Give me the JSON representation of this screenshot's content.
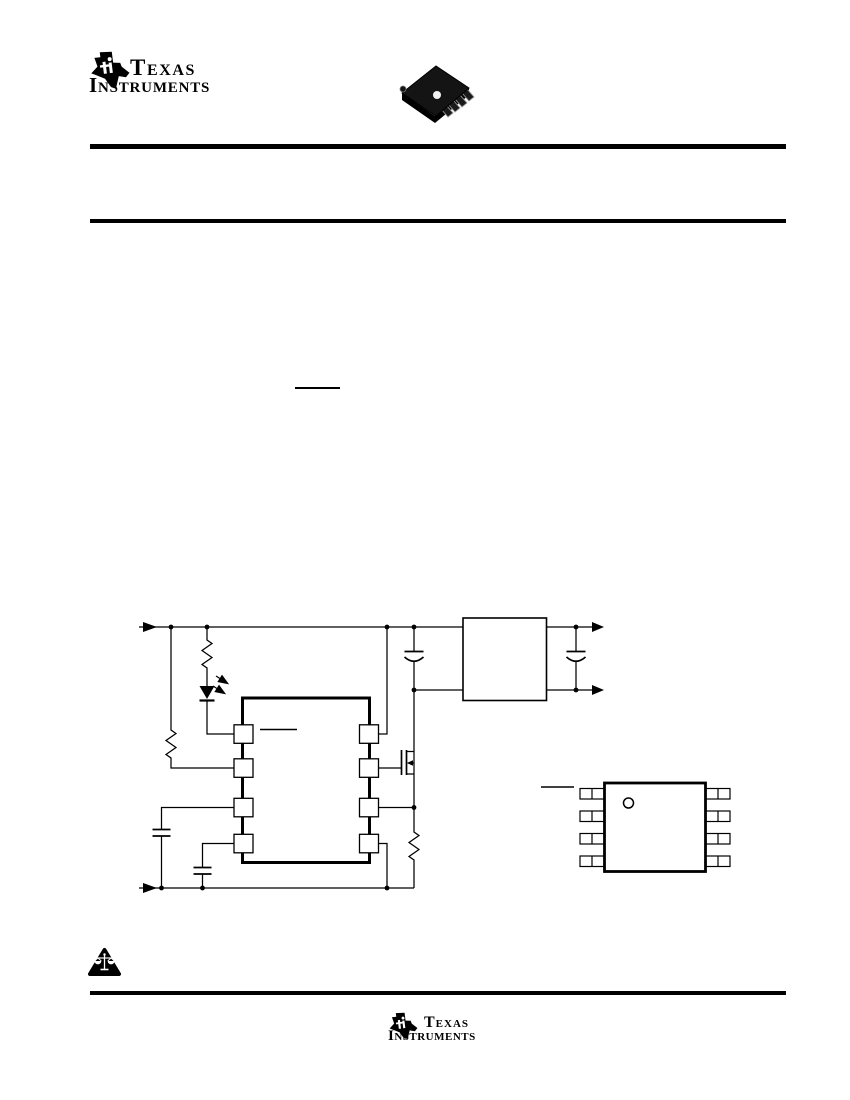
{
  "page": {
    "width": 850,
    "height": 1100,
    "background": "#ffffff",
    "ink_color": "#000000"
  },
  "brand": {
    "name_line1": "Texas",
    "name_line2": "Instruments"
  },
  "header": {
    "package_photo": "msop-8-surface-mount-package-photo",
    "rules": [
      "header-top-rule",
      "header-bottom-rule"
    ]
  },
  "artifacts": {
    "body_overline": "overbar-of-redacted-text",
    "schematic_pin_overline": "overbar-of-redacted-pin-label",
    "pinout_overline": "overbar-of-redacted-pin-label"
  },
  "schematic": {
    "title": "typical-application-circuit",
    "ic": {
      "type": "8-pin-controller",
      "left_pins": 4,
      "right_pins": 4
    },
    "components": [
      {
        "name": "input-terminal-arrow",
        "type": "terminal"
      },
      {
        "name": "r1",
        "type": "resistor"
      },
      {
        "name": "r2",
        "type": "resistor"
      },
      {
        "name": "d1",
        "type": "led-with-emission-arrows"
      },
      {
        "name": "q1",
        "type": "n-channel-mosfet"
      },
      {
        "name": "c1",
        "type": "capacitor"
      },
      {
        "name": "c2",
        "type": "capacitor"
      },
      {
        "name": "c3",
        "type": "polarized-capacitor"
      },
      {
        "name": "c4",
        "type": "polarized-capacitor"
      },
      {
        "name": "r3",
        "type": "resistor"
      },
      {
        "name": "t1",
        "type": "module-box"
      },
      {
        "name": "output-terminal-arrows",
        "type": "terminal"
      },
      {
        "name": "ground-return-rail",
        "type": "rail"
      }
    ]
  },
  "pinout": {
    "package": "8-lead-package-top-view",
    "leads_per_side": 4,
    "pin1_indicator": "circle"
  },
  "footer": {
    "notice_icon": "scales-in-triangle-icon",
    "rule": "footer-rule"
  }
}
